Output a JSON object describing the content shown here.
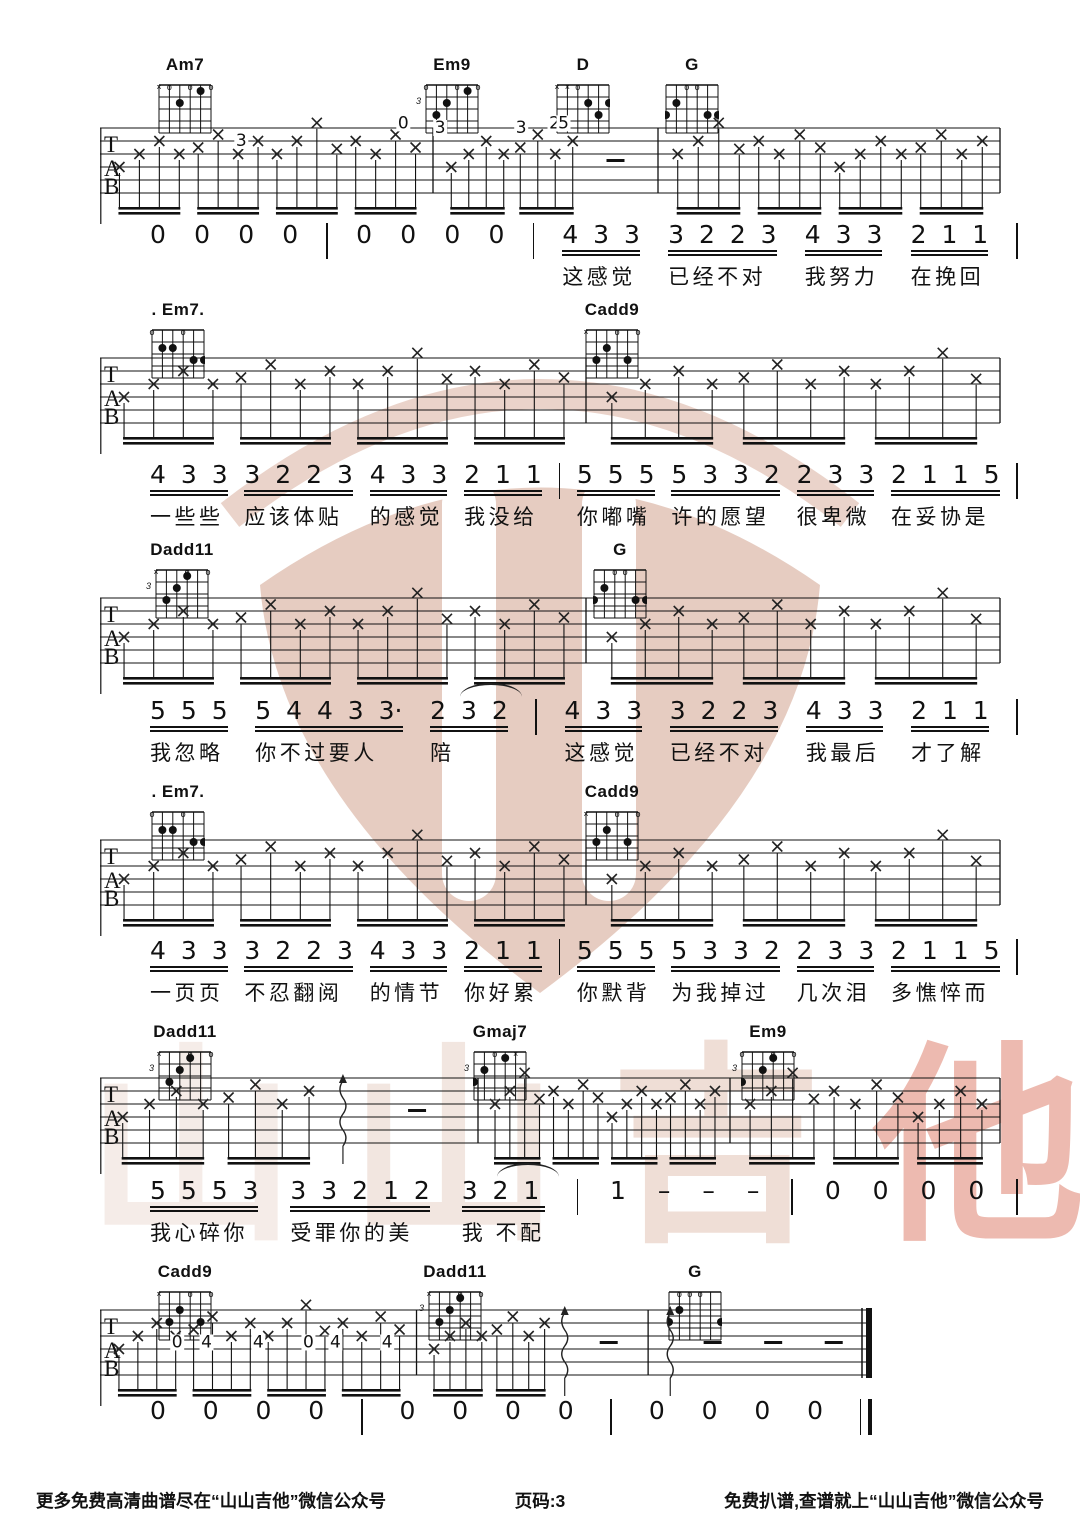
{
  "page": {
    "width": 1080,
    "height": 1527,
    "background": "#ffffff",
    "ink": "#111111",
    "page_number_label": "页码:3"
  },
  "watermark": {
    "brand": "山山吉他",
    "logo_color": "#e3c4b8",
    "text_chars": [
      {
        "ch": "山",
        "color": "#f3e8e3"
      },
      {
        "ch": "山",
        "color": "#efe0d9"
      },
      {
        "ch": "吉",
        "color": "#ecd6cc"
      },
      {
        "ch": "他",
        "color": "#e9aa9d"
      }
    ]
  },
  "footer": {
    "left": "更多免费高清曲谱尽在“山山吉他”微信公众号",
    "center": "页码:3",
    "right": "免费扒谱,查谱就上“山山吉他”微信公众号"
  },
  "systems": [
    {
      "chord_y": 55,
      "staff_top": 128,
      "vocal_top": 222,
      "staff_x": 100,
      "staff_w": 900,
      "chords": [
        {
          "name": "Am7",
          "cx": 185,
          "fret": "",
          "markers": [
            "x",
            "o",
            "",
            "o",
            "",
            "o"
          ],
          "dots": [
            [
              3,
              2
            ],
            [
              5,
              1
            ]
          ]
        },
        {
          "name": "Em9",
          "cx": 452,
          "fret": "3",
          "markers": [
            "o",
            "",
            "",
            "o",
            "",
            "o"
          ],
          "dots": [
            [
              2,
              3
            ],
            [
              3,
              2
            ],
            [
              5,
              1
            ]
          ]
        },
        {
          "name": "D",
          "cx": 583,
          "fret": "",
          "markers": [
            "x",
            "x",
            "o",
            "",
            "",
            ""
          ],
          "dots": [
            [
              4,
              2
            ],
            [
              6,
              2
            ],
            [
              5,
              3
            ]
          ]
        },
        {
          "name": "G",
          "cx": 692,
          "fret": "",
          "markers": [
            "",
            "",
            "o",
            "o",
            "",
            ""
          ],
          "dots": [
            [
              2,
              2
            ],
            [
              1,
              3
            ],
            [
              5,
              3
            ],
            [
              6,
              3
            ]
          ]
        }
      ],
      "bars": [
        0.37,
        0.62,
        1.0
      ],
      "measures": [
        {
          "parts": [
            [
              "g",
              4
            ]
          ]
        },
        {
          "parts": [
            [
              "g",
              2
            ],
            [
              "dash",
              1
            ]
          ]
        },
        {
          "parts": [
            [
              "g",
              4
            ]
          ]
        }
      ],
      "tab_nums": [
        {
          "f": 0.157,
          "row": 1,
          "v": "3"
        },
        {
          "f": 0.337,
          "row": -0.35,
          "v": "0"
        },
        {
          "f": 0.505,
          "row": -0.35,
          "v": "2"
        },
        {
          "f": 0.378,
          "row": 0,
          "v": "3"
        },
        {
          "f": 0.468,
          "row": 0,
          "v": "3"
        },
        {
          "f": 0.515,
          "row": -0.35,
          "v": "5"
        }
      ],
      "end": "bar",
      "vocal": {
        "x": 150,
        "w": 868,
        "segments": [
          {
            "n": "0"
          },
          {
            "n": "0"
          },
          {
            "n": "0"
          },
          {
            "n": "0"
          },
          {
            "bar": true
          },
          {
            "n": "0"
          },
          {
            "n": "0"
          },
          {
            "n": "0"
          },
          {
            "n": "0"
          },
          {
            "bar": true
          },
          {
            "n": "4 3 3",
            "u": 1,
            "l": "这感觉"
          },
          {
            "n": "3 2 2 3",
            "u": 1,
            "l": "已经不对"
          },
          {
            "n": "4 3 3",
            "u": 1,
            "l": "我努力"
          },
          {
            "n": "2 1 1",
            "u": 1,
            "l": "在挽回"
          },
          {
            "bar": true
          }
        ]
      }
    },
    {
      "chord_y": 300,
      "staff_top": 358,
      "vocal_top": 462,
      "staff_x": 100,
      "staff_w": 900,
      "chords": [
        {
          "name": ". Em7.",
          "cx": 178,
          "fret": "",
          "markers": [
            "o",
            "",
            "",
            "o",
            "",
            ""
          ],
          "dots": [
            [
              2,
              2
            ],
            [
              3,
              2
            ],
            [
              5,
              3
            ],
            [
              6,
              3
            ]
          ]
        },
        {
          "name": "Cadd9",
          "cx": 612,
          "fret": "",
          "markers": [
            "x",
            "",
            "",
            "o",
            "",
            "o"
          ],
          "dots": [
            [
              2,
              3
            ],
            [
              3,
              2
            ],
            [
              5,
              3
            ]
          ]
        }
      ],
      "bars": [
        0.54,
        1.0
      ],
      "measures": [
        {
          "parts": [
            [
              "g",
              4
            ]
          ]
        },
        {
          "parts": [
            [
              "g",
              3
            ]
          ]
        }
      ],
      "tab_nums": [],
      "end": "bar",
      "vocal": {
        "x": 150,
        "w": 868,
        "segments": [
          {
            "n": "4 3 3",
            "u": 1,
            "l": "一些些"
          },
          {
            "n": "3 2 2 3",
            "u": 1,
            "l": "应该体贴"
          },
          {
            "n": "4 3 3",
            "u": 1,
            "l": "的感觉"
          },
          {
            "n": "2 1 1",
            "u": 1,
            "l": "我没给"
          },
          {
            "bar": true
          },
          {
            "n": "5 5 5",
            "u": 1,
            "l": "你嘟嘴"
          },
          {
            "n": "5 3 3 2",
            "u": 1,
            "l": "许的愿望"
          },
          {
            "n": "2 3 3",
            "u": 1,
            "l": "很卑微"
          },
          {
            "n": "2 1 1 5",
            "u": 1,
            "l": "在妥协是"
          },
          {
            "bar": true
          }
        ]
      }
    },
    {
      "chord_y": 540,
      "staff_top": 598,
      "vocal_top": 698,
      "staff_x": 100,
      "staff_w": 900,
      "chords": [
        {
          "name": "Dadd11",
          "cx": 182,
          "fret": "3",
          "markers": [
            "x",
            "",
            "",
            "o",
            "",
            "o"
          ],
          "dots": [
            [
              4,
              1
            ],
            [
              3,
              2
            ],
            [
              2,
              3
            ]
          ]
        },
        {
          "name": "G",
          "cx": 620,
          "fret": "",
          "markers": [
            "",
            "",
            "o",
            "o",
            "",
            ""
          ],
          "dots": [
            [
              2,
              2
            ],
            [
              1,
              3
            ],
            [
              5,
              3
            ],
            [
              6,
              3
            ]
          ]
        }
      ],
      "bars": [
        0.54,
        1.0
      ],
      "measures": [
        {
          "parts": [
            [
              "g",
              4
            ]
          ]
        },
        {
          "parts": [
            [
              "g",
              3
            ]
          ]
        }
      ],
      "tab_nums": [],
      "end": "bar",
      "vocal": {
        "x": 150,
        "w": 868,
        "segments": [
          {
            "n": "5 5 5",
            "u": 1,
            "l": "我忽略"
          },
          {
            "n": "5 4 4 3 3·",
            "u": 1,
            "l": "你不过要人"
          },
          {
            "n": "2 3 2",
            "u": 1,
            "l": "陪",
            "tie": 1
          },
          {
            "bar": true
          },
          {
            "n": "4 3 3",
            "u": 1,
            "l": "这感觉"
          },
          {
            "n": "3 2 2 3",
            "u": 1,
            "l": "已经不对"
          },
          {
            "n": "4 3 3",
            "u": 1,
            "l": "我最后"
          },
          {
            "n": "2 1 1",
            "u": 1,
            "l": "才了解"
          },
          {
            "bar": true
          }
        ]
      }
    },
    {
      "chord_y": 782,
      "staff_top": 840,
      "vocal_top": 938,
      "staff_x": 100,
      "staff_w": 900,
      "chords": [
        {
          "name": ". Em7.",
          "cx": 178,
          "fret": "",
          "markers": [
            "o",
            "",
            "",
            "o",
            "",
            ""
          ],
          "dots": [
            [
              2,
              2
            ],
            [
              3,
              2
            ],
            [
              5,
              3
            ],
            [
              6,
              3
            ]
          ]
        },
        {
          "name": "Cadd9",
          "cx": 612,
          "fret": "",
          "markers": [
            "x",
            "",
            "",
            "o",
            "",
            "o"
          ],
          "dots": [
            [
              2,
              3
            ],
            [
              3,
              2
            ],
            [
              5,
              3
            ]
          ]
        }
      ],
      "bars": [
        0.54,
        1.0
      ],
      "measures": [
        {
          "parts": [
            [
              "g",
              4
            ]
          ]
        },
        {
          "parts": [
            [
              "g",
              3
            ]
          ]
        }
      ],
      "tab_nums": [],
      "end": "bar",
      "vocal": {
        "x": 150,
        "w": 868,
        "segments": [
          {
            "n": "4 3 3",
            "u": 1,
            "l": "一页页"
          },
          {
            "n": "3 2 2 3",
            "u": 1,
            "l": "不忍翻阅"
          },
          {
            "n": "4 3 3",
            "u": 1,
            "l": "的情节"
          },
          {
            "n": "2 1 1",
            "u": 1,
            "l": "你好累"
          },
          {
            "bar": true
          },
          {
            "n": "5 5 5",
            "u": 1,
            "l": "你默背"
          },
          {
            "n": "5 3 3 2",
            "u": 1,
            "l": "为我掉过"
          },
          {
            "n": "2 3 3",
            "u": 1,
            "l": "几次泪"
          },
          {
            "n": "2 1 1 5",
            "u": 1,
            "l": "多憔悴而"
          },
          {
            "bar": true
          }
        ]
      }
    },
    {
      "chord_y": 1022,
      "staff_top": 1078,
      "vocal_top": 1178,
      "staff_x": 100,
      "staff_w": 900,
      "chords": [
        {
          "name": "Dadd11",
          "cx": 185,
          "fret": "3",
          "markers": [
            "x",
            "",
            "",
            "o",
            "",
            "o"
          ],
          "dots": [
            [
              4,
              1
            ],
            [
              3,
              2
            ],
            [
              2,
              3
            ]
          ]
        },
        {
          "name": "Gmaj7",
          "cx": 500,
          "fret": "3",
          "markers": [
            "",
            "",
            "o",
            "",
            "x",
            ""
          ],
          "dots": [
            [
              4,
              1
            ],
            [
              2,
              2
            ],
            [
              1,
              3
            ]
          ]
        },
        {
          "name": "Em9",
          "cx": 768,
          "fret": "3",
          "markers": [
            "o",
            "",
            "",
            "o",
            "",
            "o"
          ],
          "dots": [
            [
              4,
              1
            ],
            [
              3,
              2
            ],
            [
              1,
              3
            ]
          ]
        }
      ],
      "bars": [
        0.42,
        0.7,
        1.0
      ],
      "measures": [
        {
          "parts": [
            [
              "g",
              2
            ],
            [
              "wave"
            ],
            [
              "dash",
              1
            ]
          ]
        },
        {
          "parts": [
            [
              "g",
              4
            ]
          ]
        },
        {
          "parts": [
            [
              "g",
              3
            ]
          ]
        }
      ],
      "tab_nums": [],
      "end": "bar",
      "vocal": {
        "x": 150,
        "w": 868,
        "segments": [
          {
            "n": "5 5 5 3",
            "u": 1,
            "l": "我心碎你"
          },
          {
            "n": "3 3 2 1 2",
            "u": 1,
            "l": "受罪你的美"
          },
          {
            "n": "3 2 1",
            "u": 1,
            "l": "我 不配",
            "tie": 1
          },
          {
            "bar": true
          },
          {
            "n": "1"
          },
          {
            "n": "–"
          },
          {
            "n": "–"
          },
          {
            "n": "–"
          },
          {
            "bar": true
          },
          {
            "n": "0"
          },
          {
            "n": "0"
          },
          {
            "n": "0"
          },
          {
            "n": "0"
          },
          {
            "bar": true
          }
        ]
      }
    },
    {
      "chord_y": 1262,
      "staff_top": 1310,
      "vocal_top": 1398,
      "staff_x": 100,
      "staff_w": 772,
      "chords": [
        {
          "name": "Cadd9",
          "cx": 185,
          "fret": "",
          "markers": [
            "x",
            "",
            "",
            "o",
            "",
            "o"
          ],
          "dots": [
            [
              2,
              3
            ],
            [
              3,
              2
            ],
            [
              5,
              3
            ]
          ]
        },
        {
          "name": "Dadd11",
          "cx": 455,
          "fret": "3",
          "markers": [
            "x",
            "",
            "",
            "o",
            "",
            "o"
          ],
          "dots": [
            [
              4,
              1
            ],
            [
              3,
              2
            ],
            [
              2,
              3
            ]
          ]
        },
        {
          "name": "G",
          "cx": 695,
          "fret": "",
          "markers": [
            "",
            "o",
            "o",
            "o",
            "",
            ""
          ],
          "dots": [
            [
              2,
              2
            ],
            [
              1,
              3
            ],
            [
              6,
              3
            ]
          ]
        }
      ],
      "bars": [
        0.41,
        0.71,
        1.0
      ],
      "measures": [
        {
          "parts": [
            [
              "g",
              4
            ]
          ]
        },
        {
          "parts": [
            [
              "g",
              2
            ],
            [
              "wave"
            ],
            [
              "dash",
              1
            ]
          ]
        },
        {
          "parts": [
            [
              "wave"
            ],
            [
              "dash",
              3
            ]
          ]
        }
      ],
      "tab_nums": [
        {
          "f": 0.1,
          "row": 2.5,
          "v": "0"
        },
        {
          "f": 0.138,
          "row": 2.5,
          "v": "4"
        },
        {
          "f": 0.205,
          "row": 2.5,
          "v": "4"
        },
        {
          "f": 0.27,
          "row": 2.5,
          "v": "0"
        },
        {
          "f": 0.305,
          "row": 2.5,
          "v": "4"
        },
        {
          "f": 0.372,
          "row": 2.5,
          "v": "4"
        }
      ],
      "end": "double",
      "vocal": {
        "x": 150,
        "w": 722,
        "segments": [
          {
            "n": "0"
          },
          {
            "n": "0"
          },
          {
            "n": "0"
          },
          {
            "n": "0"
          },
          {
            "bar": true
          },
          {
            "n": "0"
          },
          {
            "n": "0"
          },
          {
            "n": "0"
          },
          {
            "n": "0"
          },
          {
            "bar": true
          },
          {
            "n": "0"
          },
          {
            "n": "0"
          },
          {
            "n": "0"
          },
          {
            "n": "0"
          },
          {
            "end": true
          }
        ]
      }
    }
  ]
}
